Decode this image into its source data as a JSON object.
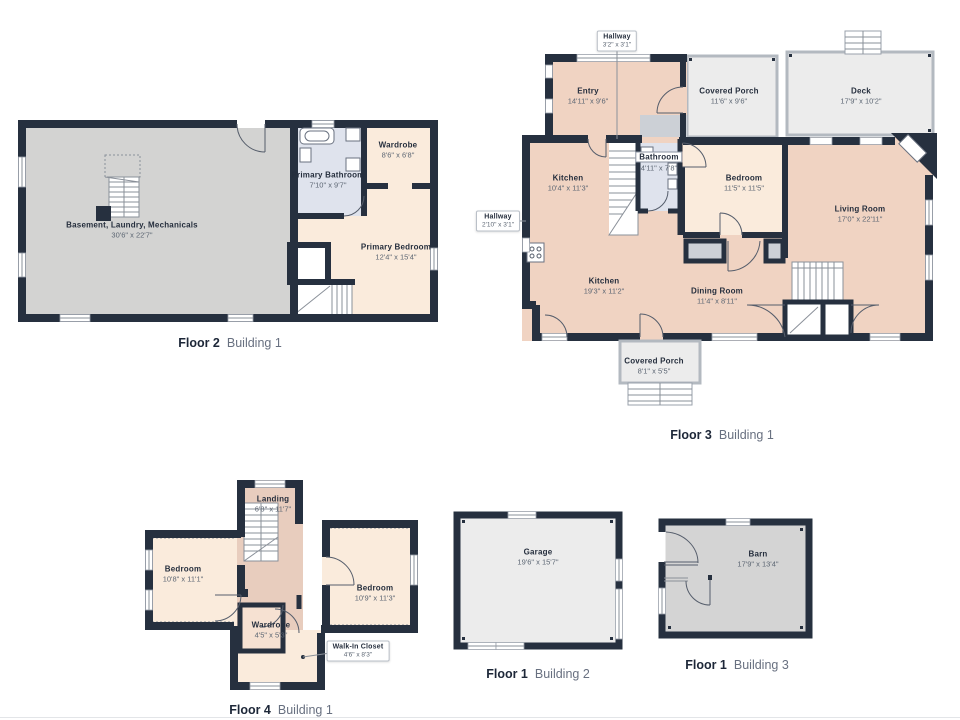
{
  "colors": {
    "wall": "#26303f",
    "room_salmon": "#f0d3c2",
    "room_peach": "#faebdc",
    "room_peach_dark": "#e8cdbe",
    "room_blue": "#dfe3ed",
    "room_gray_light": "#ececec",
    "room_gray_mid": "#d3d3d2",
    "porch_wall": "#b3b9c0"
  },
  "plans": [
    {
      "id": "floor2-building1",
      "caption": {
        "floor": "Floor 2",
        "building": "Building 1"
      },
      "rooms": [
        {
          "name": "Basement, Laundry, Mechanicals",
          "dims": "30'6\" x 22'7\""
        },
        {
          "name": "Primary Bathroom",
          "dims": "7'10\" x 9'7\""
        },
        {
          "name": "Wardrobe",
          "dims": "8'6\" x 6'8\""
        },
        {
          "name": "Primary Bedroom",
          "dims": "12'4\" x 15'4\""
        }
      ]
    },
    {
      "id": "floor3-building1",
      "caption": {
        "floor": "Floor 3",
        "building": "Building 1"
      },
      "rooms": [
        {
          "name": "Hallway",
          "dims": "3'2\" x 3'1\""
        },
        {
          "name": "Entry",
          "dims": "14'11\" x 9'6\""
        },
        {
          "name": "Covered Porch",
          "dims": "11'6\" x 9'6\""
        },
        {
          "name": "Deck",
          "dims": "17'9\" x 10'2\""
        },
        {
          "name": "Hallway",
          "dims": "2'10\" x 3'1\""
        },
        {
          "name": "Kitchen",
          "dims": "10'4\" x 11'3\""
        },
        {
          "name": "Bathroom",
          "dims": "4'11\" x 7'8\""
        },
        {
          "name": "Bedroom",
          "dims": "11'5\" x 11'5\""
        },
        {
          "name": "Living Room",
          "dims": "17'0\" x 22'11\""
        },
        {
          "name": "Kitchen",
          "dims": "19'3\" x 11'2\""
        },
        {
          "name": "Dining Room",
          "dims": "11'4\" x 8'11\""
        },
        {
          "name": "Covered Porch",
          "dims": "8'1\" x 5'5\""
        }
      ]
    },
    {
      "id": "floor4-building1",
      "caption": {
        "floor": "Floor 4",
        "building": "Building 1"
      },
      "rooms": [
        {
          "name": "Landing",
          "dims": "6'8\" x 11'7\""
        },
        {
          "name": "Bedroom",
          "dims": "10'8\" x 11'1\""
        },
        {
          "name": "Bedroom",
          "dims": "10'9\" x 11'3\""
        },
        {
          "name": "Wardrobe",
          "dims": "4'5\" x 5'3\""
        },
        {
          "name": "Walk-In Closet",
          "dims": "4'6\" x 8'3\""
        }
      ]
    },
    {
      "id": "floor1-building2",
      "caption": {
        "floor": "Floor 1",
        "building": "Building 2"
      },
      "rooms": [
        {
          "name": "Garage",
          "dims": "19'6\" x 15'7\""
        }
      ]
    },
    {
      "id": "floor1-building3",
      "caption": {
        "floor": "Floor 1",
        "building": "Building 3"
      },
      "rooms": [
        {
          "name": "Barn",
          "dims": "17'9\" x 13'4\""
        }
      ]
    }
  ]
}
